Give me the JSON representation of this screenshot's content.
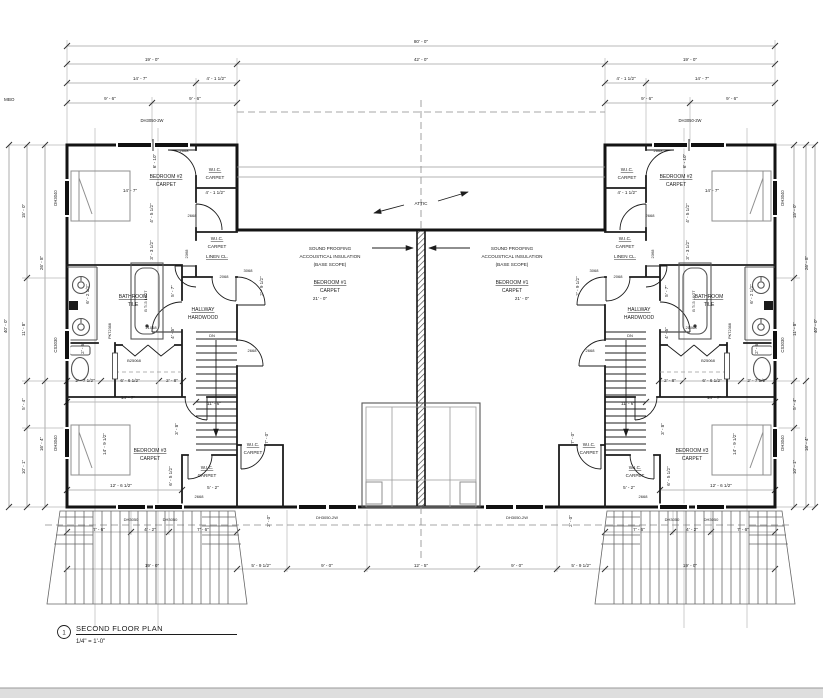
{
  "title_block": {
    "number": "1",
    "title": "SECOND FLOOR PLAN",
    "scale": "1/4\" = 1'-0\""
  },
  "colors": {
    "wall": "#141414",
    "dimension": "#777",
    "text": "#1c1c1c",
    "light_gray": "#b9b9b9",
    "sheet_edge": "#dedede"
  },
  "labels": [
    {
      "t": "MBO",
      "x": 4,
      "y": 101,
      "a": "start"
    },
    {
      "t": "80' - 0\"",
      "x": 421,
      "y": 43
    },
    {
      "t": "19' - 0\"",
      "x": 152,
      "y": 61
    },
    {
      "t": "42' - 0\"",
      "x": 421,
      "y": 61
    },
    {
      "t": "19' - 0\"",
      "x": 690,
      "y": 61
    },
    {
      "t": "14' - 7\"",
      "x": 140,
      "y": 80
    },
    {
      "t": "4' - 1 1/2\"",
      "x": 216,
      "y": 80
    },
    {
      "t": "4' - 1 1/2\"",
      "x": 626,
      "y": 80
    },
    {
      "t": "14' - 7\"",
      "x": 702,
      "y": 80
    },
    {
      "t": "9' - 6\"",
      "x": 110,
      "y": 100
    },
    {
      "t": "9' - 6\"",
      "x": 195,
      "y": 100
    },
    {
      "t": "9' - 6\"",
      "x": 647,
      "y": 100
    },
    {
      "t": "9' - 6\"",
      "x": 732,
      "y": 100
    },
    {
      "t": "DH3050-2W",
      "x": 152,
      "y": 122,
      "s": 4.2
    },
    {
      "t": "DH3050-2W",
      "x": 690,
      "y": 122,
      "s": 4.2
    },
    {
      "t": "40' - 0\"",
      "x": 7,
      "y": 326,
      "r": -90
    },
    {
      "t": "15' - 0\"",
      "x": 25,
      "y": 211,
      "r": -90
    },
    {
      "t": "11' - 8\"",
      "x": 25,
      "y": 329,
      "r": -90
    },
    {
      "t": "5' - 4\"",
      "x": 25,
      "y": 404,
      "r": -90
    },
    {
      "t": "10' - 1\"",
      "x": 25,
      "y": 467,
      "r": -90
    },
    {
      "t": "26' - 8\"",
      "x": 43,
      "y": 263,
      "r": -90
    },
    {
      "t": "16' - 4\"",
      "x": 43,
      "y": 444,
      "r": -90
    },
    {
      "t": "DH3040",
      "x": 57,
      "y": 198,
      "r": -90,
      "s": 4.2
    },
    {
      "t": "CS3030",
      "x": 57,
      "y": 345,
      "r": -90,
      "s": 4.2
    },
    {
      "t": "DH3040",
      "x": 57,
      "y": 443,
      "r": -90,
      "s": 4.2
    },
    {
      "t": "40' - 0\"",
      "x": 817,
      "y": 326,
      "r": -90
    },
    {
      "t": "15' - 0\"",
      "x": 796,
      "y": 211,
      "r": -90
    },
    {
      "t": "11' - 8\"",
      "x": 796,
      "y": 329,
      "r": -90
    },
    {
      "t": "5' - 4\"",
      "x": 796,
      "y": 404,
      "r": -90
    },
    {
      "t": "10' - 1\"",
      "x": 796,
      "y": 467,
      "r": -90
    },
    {
      "t": "26' - 8\"",
      "x": 808,
      "y": 263,
      "r": -90
    },
    {
      "t": "16' - 4\"",
      "x": 808,
      "y": 444,
      "r": -90
    },
    {
      "t": "DH3040",
      "x": 784,
      "y": 198,
      "r": -90,
      "s": 4.2
    },
    {
      "t": "CS3030",
      "x": 784,
      "y": 345,
      "r": -90,
      "s": 4.2
    },
    {
      "t": "DH3040",
      "x": 784,
      "y": 443,
      "r": -90,
      "s": 4.2
    },
    {
      "t": "2668",
      "x": 184,
      "y": 152,
      "s": 4
    },
    {
      "t": "BEDROOM #2",
      "x": 166,
      "y": 178,
      "s": 5,
      "u": 1
    },
    {
      "t": "CARPET",
      "x": 166,
      "y": 186,
      "s": 5
    },
    {
      "t": "W.I.C.",
      "x": 215,
      "y": 171,
      "s": 4.6,
      "u": 1
    },
    {
      "t": "CARPET",
      "x": 215,
      "y": 179,
      "s": 4.6
    },
    {
      "t": "6' - 10\"",
      "x": 156,
      "y": 161,
      "r": -90
    },
    {
      "t": "14' - 7\"",
      "x": 130,
      "y": 192
    },
    {
      "t": "4' - 1 1/2\"",
      "x": 215,
      "y": 194
    },
    {
      "t": "2668",
      "x": 192,
      "y": 217,
      "s": 4
    },
    {
      "t": "W.I.C.",
      "x": 217,
      "y": 240,
      "s": 4.6,
      "u": 1
    },
    {
      "t": "CARPET",
      "x": 217,
      "y": 248,
      "s": 4.6
    },
    {
      "t": "4' - 5 1/2\"",
      "x": 153,
      "y": 213,
      "r": -90
    },
    {
      "t": "LINEN CL.",
      "x": 217,
      "y": 258,
      "s": 4.6,
      "u": 1
    },
    {
      "t": "2368",
      "x": 188,
      "y": 254,
      "r": -90,
      "s": 4
    },
    {
      "t": "2068",
      "x": 224,
      "y": 278,
      "s": 4
    },
    {
      "t": "3068",
      "x": 248,
      "y": 272,
      "s": 4
    },
    {
      "t": "3' - 3 1/2\"",
      "x": 153,
      "y": 250,
      "r": -90
    },
    {
      "t": "2' - 9 1/2\"",
      "x": 263,
      "y": 286,
      "r": -90
    },
    {
      "t": "BATHROOM",
      "x": 133,
      "y": 298,
      "s": 5,
      "u": 1
    },
    {
      "t": "TILE",
      "x": 133,
      "y": 306,
      "s": 5
    },
    {
      "t": "B T/-5 L&GT",
      "x": 147,
      "y": 301,
      "r": -90,
      "s": 3.8
    },
    {
      "t": "6' - 2 1/2\"",
      "x": 89,
      "y": 294,
      "r": -90
    },
    {
      "t": "5' - 7\"",
      "x": 174,
      "y": 291,
      "r": -90
    },
    {
      "t": "4' - 5\"",
      "x": 174,
      "y": 333,
      "r": -90
    },
    {
      "t": "PKT2368",
      "x": 111,
      "y": 331,
      "r": -90,
      "s": 3.8
    },
    {
      "t": "21068",
      "x": 151,
      "y": 329,
      "s": 4
    },
    {
      "t": "B25068",
      "x": 134,
      "y": 362,
      "s": 4
    },
    {
      "t": "2' - 6\"",
      "x": 84,
      "y": 348,
      "r": -90
    },
    {
      "t": "HALLWAY",
      "x": 203,
      "y": 311,
      "s": 5,
      "u": 1
    },
    {
      "t": "HARDWOOD",
      "x": 203,
      "y": 319,
      "s": 5
    },
    {
      "t": "DN",
      "x": 212,
      "y": 337,
      "s": 4
    },
    {
      "t": "11' - 6\"",
      "x": 214,
      "y": 405
    },
    {
      "t": "21' - 0\"",
      "x": 320,
      "y": 300
    },
    {
      "t": "SOUND PROOFING",
      "x": 330,
      "y": 250
    },
    {
      "t": "ACCOUSTICAL INSULATION",
      "x": 330,
      "y": 258
    },
    {
      "t": "(BASE SCOPE)",
      "x": 330,
      "y": 266
    },
    {
      "t": "BEDROOM #1",
      "x": 330,
      "y": 284,
      "s": 5,
      "u": 1
    },
    {
      "t": "CARPET",
      "x": 330,
      "y": 292,
      "s": 5
    },
    {
      "t": "ATTIC",
      "x": 421,
      "y": 205
    },
    {
      "t": "2' - 7 1/2\"",
      "x": 85,
      "y": 382
    },
    {
      "t": "6' - 6 1/2\"",
      "x": 130,
      "y": 382
    },
    {
      "t": "2' - 8\"",
      "x": 172,
      "y": 382
    },
    {
      "t": "14' - 7\"",
      "x": 128,
      "y": 399
    },
    {
      "t": "3' - 8\"",
      "x": 178,
      "y": 429,
      "r": -90
    },
    {
      "t": "2668",
      "x": 252,
      "y": 352,
      "s": 4
    },
    {
      "t": "W.I.C.",
      "x": 253,
      "y": 446,
      "s": 4.6,
      "u": 1
    },
    {
      "t": "CARPET",
      "x": 253,
      "y": 454,
      "s": 4.6
    },
    {
      "t": "7' - 0\"",
      "x": 268,
      "y": 438,
      "r": -90
    },
    {
      "t": "2' - 0\"",
      "x": 270,
      "y": 521,
      "r": -90
    },
    {
      "t": "BEDROOM #3",
      "x": 150,
      "y": 452,
      "s": 5,
      "u": 1
    },
    {
      "t": "CARPET",
      "x": 150,
      "y": 460,
      "s": 5
    },
    {
      "t": "14' - 9 1/2\"",
      "x": 106,
      "y": 444,
      "r": -90
    },
    {
      "t": "W.I.C.",
      "x": 207,
      "y": 469,
      "s": 4.6,
      "u": 1
    },
    {
      "t": "CARPET",
      "x": 207,
      "y": 477,
      "s": 4.6
    },
    {
      "t": "6' - 5 1/2\"",
      "x": 172,
      "y": 476,
      "r": -90
    },
    {
      "t": "5' - 2\"",
      "x": 213,
      "y": 489
    },
    {
      "t": "2668",
      "x": 199,
      "y": 498,
      "s": 4
    },
    {
      "t": "12' - 6 1/2\"",
      "x": 121,
      "y": 487
    },
    {
      "t": "DH3050",
      "x": 131,
      "y": 521,
      "s": 4
    },
    {
      "t": "DH3050",
      "x": 170,
      "y": 521,
      "s": 4
    },
    {
      "t": "7' - 6\"",
      "x": 99,
      "y": 531
    },
    {
      "t": "4' - 2\"",
      "x": 150,
      "y": 531
    },
    {
      "t": "7' - 6\"",
      "x": 203,
      "y": 531
    },
    {
      "t": "19' - 0\"",
      "x": 152,
      "y": 567
    },
    {
      "t": "5' - 9 1/2\"",
      "x": 261,
      "y": 567
    },
    {
      "t": "DH3050-2W",
      "x": 327,
      "y": 519,
      "s": 4
    },
    {
      "t": "DH3050-2W",
      "x": 517,
      "y": 519,
      "s": 4
    },
    {
      "t": "9' - 0\"",
      "x": 327,
      "y": 567
    },
    {
      "t": "12' - 5\"",
      "x": 421,
      "y": 567
    },
    {
      "t": "9' - 0\"",
      "x": 517,
      "y": 567
    },
    {
      "t": "SOUND PROOFING",
      "x": 512,
      "y": 250
    },
    {
      "t": "ACCOUSTICAL INSULATION",
      "x": 512,
      "y": 258
    },
    {
      "t": "(BASE SCOPE)",
      "x": 512,
      "y": 266
    },
    {
      "t": "BEDROOM #1",
      "x": 512,
      "y": 284,
      "s": 5,
      "u": 1
    },
    {
      "t": "CARPET",
      "x": 512,
      "y": 292,
      "s": 5
    },
    {
      "t": "21' - 0\"",
      "x": 522,
      "y": 300
    },
    {
      "t": "2668",
      "x": 658,
      "y": 152,
      "s": 4
    },
    {
      "t": "BEDROOM #2",
      "x": 676,
      "y": 178,
      "s": 5,
      "u": 1
    },
    {
      "t": "CARPET",
      "x": 676,
      "y": 186,
      "s": 5
    },
    {
      "t": "W.I.C.",
      "x": 627,
      "y": 171,
      "s": 4.6,
      "u": 1
    },
    {
      "t": "CARPET",
      "x": 627,
      "y": 179,
      "s": 4.6
    },
    {
      "t": "6' - 10\"",
      "x": 686,
      "y": 161,
      "r": -90
    },
    {
      "t": "14' - 7\"",
      "x": 712,
      "y": 192
    },
    {
      "t": "4' - 1 1/2\"",
      "x": 627,
      "y": 194
    },
    {
      "t": "2668",
      "x": 650,
      "y": 217,
      "s": 4
    },
    {
      "t": "W.I.C.",
      "x": 625,
      "y": 240,
      "s": 4.6,
      "u": 1
    },
    {
      "t": "CARPET",
      "x": 625,
      "y": 248,
      "s": 4.6
    },
    {
      "t": "4' - 5 1/2\"",
      "x": 689,
      "y": 213,
      "r": -90
    },
    {
      "t": "LINEN CL.",
      "x": 625,
      "y": 258,
      "s": 4.6,
      "u": 1
    },
    {
      "t": "2368",
      "x": 654,
      "y": 254,
      "r": -90,
      "s": 4
    },
    {
      "t": "2068",
      "x": 618,
      "y": 278,
      "s": 4
    },
    {
      "t": "3068",
      "x": 594,
      "y": 272,
      "s": 4
    },
    {
      "t": "3' - 3 1/2\"",
      "x": 689,
      "y": 250,
      "r": -90
    },
    {
      "t": "2' - 9 1/2\"",
      "x": 579,
      "y": 286,
      "r": -90
    },
    {
      "t": "BATHROOM",
      "x": 709,
      "y": 298,
      "s": 5,
      "u": 1
    },
    {
      "t": "TILE",
      "x": 709,
      "y": 306,
      "s": 5
    },
    {
      "t": "B T/-5 L&GT",
      "x": 695,
      "y": 301,
      "r": -90,
      "s": 3.8
    },
    {
      "t": "6' - 2 1/2\"",
      "x": 753,
      "y": 294,
      "r": -90
    },
    {
      "t": "5' - 7\"",
      "x": 668,
      "y": 291,
      "r": -90
    },
    {
      "t": "4' - 5\"",
      "x": 668,
      "y": 333,
      "r": -90
    },
    {
      "t": "PKT2368",
      "x": 731,
      "y": 331,
      "r": -90,
      "s": 3.8
    },
    {
      "t": "21068",
      "x": 691,
      "y": 329,
      "s": 4
    },
    {
      "t": "B25068",
      "x": 708,
      "y": 362,
      "s": 4
    },
    {
      "t": "2' - 6\"",
      "x": 758,
      "y": 348,
      "r": -90
    },
    {
      "t": "HALLWAY",
      "x": 639,
      "y": 311,
      "s": 5,
      "u": 1
    },
    {
      "t": "HARDWOOD",
      "x": 639,
      "y": 319,
      "s": 5
    },
    {
      "t": "DN",
      "x": 630,
      "y": 337,
      "s": 4
    },
    {
      "t": "11' - 6\"",
      "x": 628,
      "y": 405
    },
    {
      "t": "2' - 7 1/2\"",
      "x": 757,
      "y": 382
    },
    {
      "t": "6' - 6 1/2\"",
      "x": 712,
      "y": 382
    },
    {
      "t": "2' - 8\"",
      "x": 670,
      "y": 382
    },
    {
      "t": "14' - 7\"",
      "x": 714,
      "y": 399
    },
    {
      "t": "3' - 8\"",
      "x": 664,
      "y": 429,
      "r": -90
    },
    {
      "t": "2668",
      "x": 590,
      "y": 352,
      "s": 4
    },
    {
      "t": "W.I.C.",
      "x": 589,
      "y": 446,
      "s": 4.6,
      "u": 1
    },
    {
      "t": "CARPET",
      "x": 589,
      "y": 454,
      "s": 4.6
    },
    {
      "t": "7' - 0\"",
      "x": 574,
      "y": 438,
      "r": -90
    },
    {
      "t": "2' - 0\"",
      "x": 572,
      "y": 521,
      "r": -90
    },
    {
      "t": "BEDROOM #3",
      "x": 692,
      "y": 452,
      "s": 5,
      "u": 1
    },
    {
      "t": "CARPET",
      "x": 692,
      "y": 460,
      "s": 5
    },
    {
      "t": "14' - 9 1/2\"",
      "x": 736,
      "y": 444,
      "r": -90
    },
    {
      "t": "W.I.C.",
      "x": 635,
      "y": 469,
      "s": 4.6,
      "u": 1
    },
    {
      "t": "CARPET",
      "x": 635,
      "y": 477,
      "s": 4.6
    },
    {
      "t": "6' - 5 1/2\"",
      "x": 670,
      "y": 476,
      "r": -90
    },
    {
      "t": "5' - 2\"",
      "x": 629,
      "y": 489
    },
    {
      "t": "2668",
      "x": 643,
      "y": 498,
      "s": 4
    },
    {
      "t": "12' - 6 1/2\"",
      "x": 721,
      "y": 487
    },
    {
      "t": "DH3050",
      "x": 672,
      "y": 521,
      "s": 4
    },
    {
      "t": "DH3050",
      "x": 711,
      "y": 521,
      "s": 4
    },
    {
      "t": "7' - 6\"",
      "x": 639,
      "y": 531
    },
    {
      "t": "4' - 2\"",
      "x": 692,
      "y": 531
    },
    {
      "t": "7' - 6\"",
      "x": 743,
      "y": 531
    },
    {
      "t": "19' - 0\"",
      "x": 690,
      "y": 567
    },
    {
      "t": "5' - 9 1/2\"",
      "x": 581,
      "y": 567
    }
  ]
}
